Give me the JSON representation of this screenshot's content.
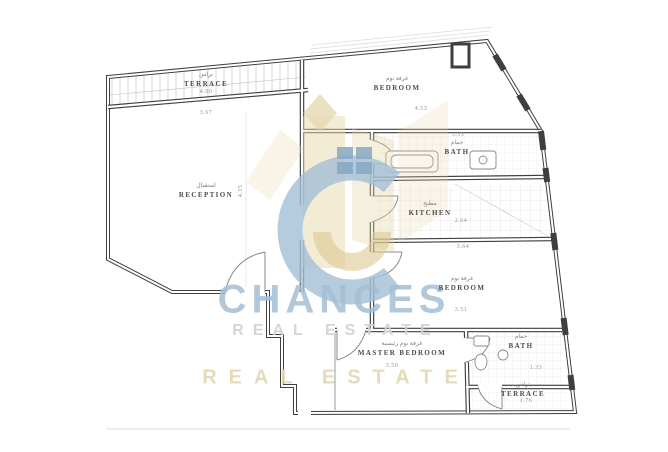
{
  "watermark": {
    "brand": "CHANCES",
    "tagline": "REAL ESTATE",
    "tagline2": "REAL ESTATE",
    "colors": {
      "blue": "#a4bfd5",
      "gold": "#e4d5a5",
      "gray": "#d3d3d3"
    }
  },
  "plan": {
    "under_terrace_dim": "3.67",
    "reception_side_dim": "4.35",
    "rooms": [
      {
        "key": "terrace-top",
        "ar": "تراس",
        "en": "TERRACE",
        "dim": "4.00"
      },
      {
        "key": "reception",
        "ar": "استقبال",
        "en": "RECEPTION"
      },
      {
        "key": "bedroom-1",
        "ar": "غرفة نوم",
        "en": "BEDROOM",
        "dim": "4.53"
      },
      {
        "key": "bath-1",
        "ar": "حمام",
        "en": "BATH",
        "dim_top": "3.33"
      },
      {
        "key": "kitchen",
        "ar": "مطبخ",
        "en": "KITCHEN",
        "dim": "2.64"
      },
      {
        "key": "bedroom-2",
        "ar": "غرفة نوم",
        "en": "BEDROOM",
        "dim_top": "3.64",
        "dim": "3.51"
      },
      {
        "key": "master-bedroom",
        "ar": "غرفة نوم رئيسية",
        "en": "MASTER BEDROOM",
        "dim": "3.50"
      },
      {
        "key": "bath-2",
        "ar": "حمام",
        "en": "BATH",
        "dim": "1.33"
      },
      {
        "key": "terrace-bottom",
        "ar": "تراس",
        "en": "TERRACE",
        "dim": "1.76"
      }
    ]
  }
}
